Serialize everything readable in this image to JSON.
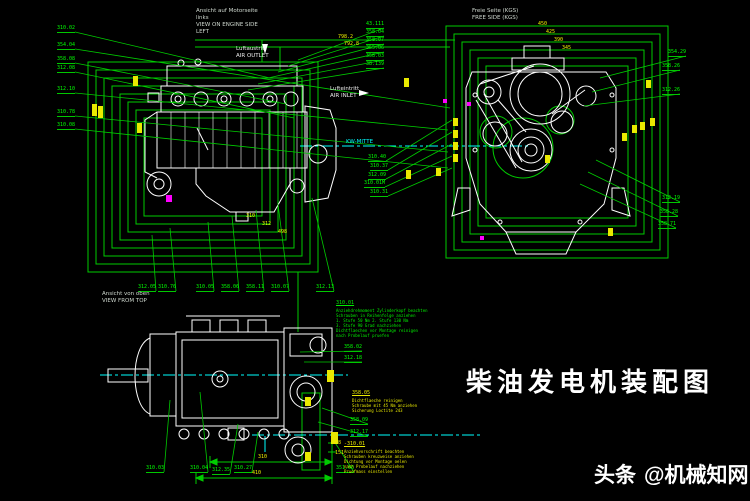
{
  "title": {
    "text": "柴油发电机装配图"
  },
  "watermark": {
    "brand": "头条",
    "handle": "@机械知网"
  },
  "colors": {
    "frame": "#00cc00",
    "label": "#00ff00",
    "dim": "#f2f200",
    "centerline": "#00ffff",
    "outline": "#ffffff",
    "accent": "#ff00ff"
  },
  "annotations": [
    {
      "x": 196,
      "y": 8,
      "color": "#cfd8cf",
      "lines": [
        "Ansicht auf Motorseite",
        "links",
        "VIEW ON ENGINE SIDE",
        "LEFT"
      ]
    },
    {
      "x": 472,
      "y": 8,
      "color": "#cfd8cf",
      "lines": [
        "Freie Seite (KGS)",
        "FREE SIDE (KGS)"
      ]
    },
    {
      "x": 102,
      "y": 291,
      "color": "#cfd8cf",
      "lines": [
        "Ansicht von oben",
        "VIEW FROM TOP"
      ]
    },
    {
      "x": 236,
      "y": 46,
      "color": "#ededed",
      "lines": [
        "Luftaustritt",
        "AIR OUTLET"
      ],
      "arrow": "down",
      "ax": 262,
      "ay": 44
    },
    {
      "x": 330,
      "y": 86,
      "color": "#ededed",
      "lines": [
        "Lufteintritt",
        "AIR INLET"
      ],
      "arrow": "right",
      "ax": 359,
      "ay": 90
    },
    {
      "x": 346,
      "y": 139,
      "color": "#00ffff",
      "lines": [
        "KW-MITTE"
      ]
    }
  ],
  "callouts": [
    {
      "t": "310.02",
      "x": 57,
      "y": 26,
      "tx": 270,
      "ty": 78
    },
    {
      "t": "354.04",
      "x": 57,
      "y": 43,
      "tx": 450,
      "ty": 108
    },
    {
      "t": "358.08",
      "x": 57,
      "y": 57,
      "tx": 286,
      "ty": 104
    },
    {
      "t": "312.08",
      "x": 57,
      "y": 66,
      "tx": 294,
      "ty": 118
    },
    {
      "t": "312.10",
      "x": 57,
      "y": 87,
      "tx": 448,
      "ty": 130
    },
    {
      "t": "310.78",
      "x": 57,
      "y": 110,
      "tx": 448,
      "ty": 152
    },
    {
      "t": "310.08",
      "x": 57,
      "y": 123,
      "tx": 448,
      "ty": 168
    },
    {
      "t": "43.111",
      "x": 366,
      "y": 22,
      "tx": 298,
      "ty": 60
    },
    {
      "t": "358.04",
      "x": 366,
      "y": 30,
      "tx": 288,
      "ty": 66
    },
    {
      "t": "358.07",
      "x": 366,
      "y": 38,
      "tx": 278,
      "ty": 72
    },
    {
      "t": "355.06",
      "x": 366,
      "y": 46,
      "tx": 268,
      "ty": 78
    },
    {
      "t": "358.03",
      "x": 366,
      "y": 54,
      "tx": 258,
      "ty": 84
    },
    {
      "t": "38.139",
      "x": 366,
      "y": 62,
      "tx": 248,
      "ty": 90
    },
    {
      "t": "310.40",
      "x": 368,
      "y": 155,
      "tx": 452,
      "ty": 120
    },
    {
      "t": "310.37",
      "x": 370,
      "y": 164,
      "tx": 452,
      "ty": 132
    },
    {
      "t": "312.09",
      "x": 368,
      "y": 173,
      "tx": 452,
      "ty": 144
    },
    {
      "t": "310.01M",
      "x": 364,
      "y": 181,
      "tx": 452,
      "ty": 156
    },
    {
      "t": "310.31",
      "x": 370,
      "y": 190,
      "tx": 452,
      "ty": 168
    },
    {
      "t": "354.29",
      "x": 668,
      "y": 50,
      "tx": 600,
      "ty": 78
    },
    {
      "t": "358.26",
      "x": 662,
      "y": 64,
      "tx": 592,
      "ty": 92
    },
    {
      "t": "312.26",
      "x": 662,
      "y": 88,
      "tx": 584,
      "ty": 106
    },
    {
      "t": "312.19",
      "x": 662,
      "y": 196,
      "tx": 596,
      "ty": 160
    },
    {
      "t": "358.28",
      "x": 660,
      "y": 210,
      "tx": 588,
      "ty": 172
    },
    {
      "t": "358.71",
      "x": 658,
      "y": 222,
      "tx": 580,
      "ty": 184
    },
    {
      "t": "312.05",
      "x": 138,
      "y": 285,
      "tx": 152,
      "ty": 235
    },
    {
      "t": "310.76",
      "x": 158,
      "y": 285,
      "tx": 170,
      "ty": 228
    },
    {
      "t": "310.05",
      "x": 196,
      "y": 285,
      "tx": 208,
      "ty": 222
    },
    {
      "t": "358.06",
      "x": 221,
      "y": 285,
      "tx": 232,
      "ty": 216
    },
    {
      "t": "358.11",
      "x": 246,
      "y": 285,
      "tx": 256,
      "ty": 210
    },
    {
      "t": "310.07",
      "x": 271,
      "y": 285,
      "tx": 278,
      "ty": 204
    },
    {
      "t": "312.13",
      "x": 316,
      "y": 285,
      "tx": 312,
      "ty": 198
    },
    {
      "t": "358.02",
      "x": 344,
      "y": 345,
      "tx": 300,
      "ty": 352
    },
    {
      "t": "312.18",
      "x": 344,
      "y": 356,
      "tx": 304,
      "ty": 362
    },
    {
      "t": "358.09",
      "x": 350,
      "y": 418,
      "tx": 322,
      "ty": 408
    },
    {
      "t": "312.17",
      "x": 350,
      "y": 430,
      "tx": 318,
      "ty": 422
    },
    {
      "t": "310.03",
      "x": 146,
      "y": 466,
      "tx": 170,
      "ty": 400
    },
    {
      "t": "310.04",
      "x": 190,
      "y": 466,
      "tx": 200,
      "ty": 392
    },
    {
      "t": "312.35",
      "x": 212,
      "y": 468,
      "tx": 238,
      "ty": 424
    },
    {
      "t": "310.27",
      "x": 234,
      "y": 466,
      "tx": 258,
      "ty": 432
    },
    {
      "t": "351.03",
      "x": 336,
      "y": 466,
      "tx": 332,
      "ty": 438
    }
  ],
  "dims": [
    {
      "t": "798.2",
      "x": 338,
      "y": 35
    },
    {
      "t": "792.8",
      "x": 344,
      "y": 42
    },
    {
      "t": "450",
      "x": 538,
      "y": 22
    },
    {
      "t": "425",
      "x": 546,
      "y": 30
    },
    {
      "t": "390",
      "x": 554,
      "y": 38
    },
    {
      "t": "345",
      "x": 562,
      "y": 46
    },
    {
      "t": "310",
      "x": 246,
      "y": 214
    },
    {
      "t": "312",
      "x": 262,
      "y": 222
    },
    {
      "t": "498",
      "x": 278,
      "y": 230
    },
    {
      "t": "310",
      "x": 258,
      "y": 455
    },
    {
      "t": "410",
      "x": 252,
      "y": 471
    },
    {
      "t": "38",
      "x": 335,
      "y": 441
    },
    {
      "t": "151",
      "x": 335,
      "y": 451
    }
  ],
  "markers": [
    {
      "x": 133,
      "y": 76,
      "w": 5,
      "h": 10
    },
    {
      "x": 92,
      "y": 104,
      "w": 5,
      "h": 12
    },
    {
      "x": 98,
      "y": 106,
      "w": 5,
      "h": 12
    },
    {
      "x": 137,
      "y": 123,
      "w": 5,
      "h": 10
    },
    {
      "x": 404,
      "y": 78,
      "w": 5,
      "h": 9
    },
    {
      "x": 406,
      "y": 170,
      "w": 5,
      "h": 9
    },
    {
      "x": 453,
      "y": 118,
      "w": 5,
      "h": 8
    },
    {
      "x": 453,
      "y": 130,
      "w": 5,
      "h": 8
    },
    {
      "x": 453,
      "y": 142,
      "w": 5,
      "h": 8
    },
    {
      "x": 453,
      "y": 154,
      "w": 5,
      "h": 8
    },
    {
      "x": 646,
      "y": 80,
      "w": 5,
      "h": 8
    },
    {
      "x": 650,
      "y": 118,
      "w": 5,
      "h": 8
    },
    {
      "x": 622,
      "y": 133,
      "w": 5,
      "h": 8
    },
    {
      "x": 632,
      "y": 125,
      "w": 5,
      "h": 8
    },
    {
      "x": 640,
      "y": 122,
      "w": 5,
      "h": 8
    },
    {
      "x": 608,
      "y": 228,
      "w": 5,
      "h": 8
    },
    {
      "x": 305,
      "y": 397,
      "w": 6,
      "h": 9
    },
    {
      "x": 305,
      "y": 452,
      "w": 6,
      "h": 9
    },
    {
      "x": 327,
      "y": 370,
      "w": 7,
      "h": 12
    },
    {
      "x": 331,
      "y": 432,
      "w": 7,
      "h": 12
    },
    {
      "x": 545,
      "y": 155,
      "w": 5,
      "h": 8
    },
    {
      "x": 436,
      "y": 168,
      "w": 5,
      "h": 8
    }
  ],
  "magenta_marks": [
    {
      "x": 166,
      "y": 195,
      "w": 6,
      "h": 7
    },
    {
      "x": 443,
      "y": 99,
      "w": 4,
      "h": 4
    },
    {
      "x": 467,
      "y": 102,
      "w": 4,
      "h": 4
    },
    {
      "x": 480,
      "y": 236,
      "w": 4,
      "h": 4
    }
  ],
  "notes": [
    {
      "header": "310.01",
      "x": 336,
      "y": 300,
      "color": "#00ee00",
      "lines": [
        "Anziehdrehmoment Zylinderkopf beachten",
        "Schrauben in Reihenfolge anziehen",
        "1. Stufe 50 Nm  2. Stufe 130 Nm",
        "3. Stufe 90 Grad nachziehen",
        "Dichtflaechen vor Montage reinigen",
        "nach Probelauf pruefen"
      ]
    },
    {
      "header": "358.05",
      "x": 352,
      "y": 390,
      "color": "#e9e900",
      "lines": [
        "Dichtflaeche reinigen",
        "Schraube mit 45 Nm anziehen",
        "Sicherung Loctite 243"
      ]
    },
    {
      "header": "-310.01",
      "x": 344,
      "y": 441,
      "color": "#e9e900",
      "lines": [
        "Anziehvorschrift beachten",
        "Schrauben kreuzweise anziehen",
        "Dichtung vor Montage oelen",
        "nach Probelauf nachziehen",
        "Pruefmass einstellen"
      ]
    }
  ]
}
